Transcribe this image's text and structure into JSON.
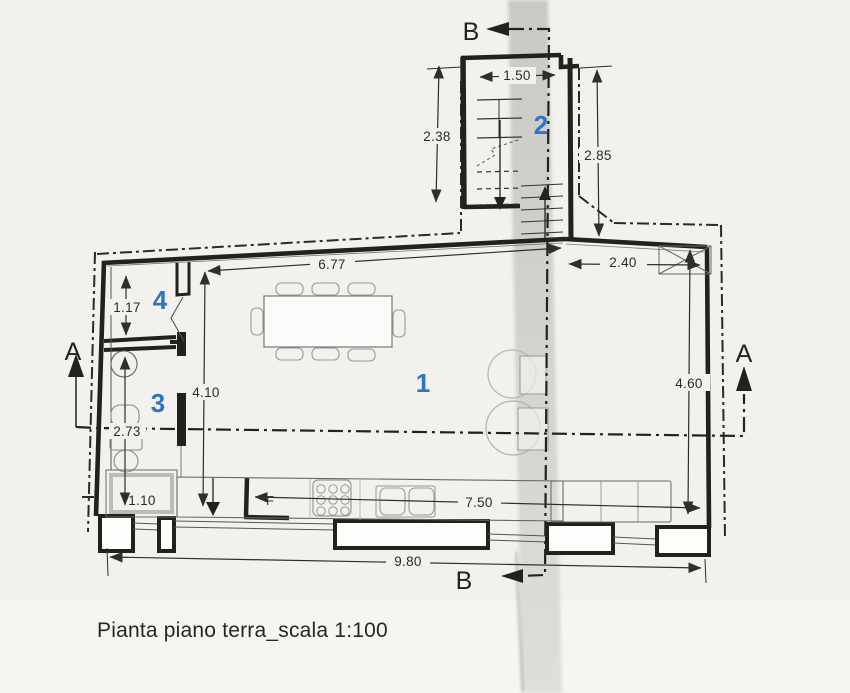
{
  "document": {
    "title": "Pianta piano terra_scala 1:100",
    "type": "scanned architectural floor plan, ground floor, scale 1:100"
  },
  "colors": {
    "paper": "#f2f1ed",
    "ink": "#22221f",
    "room_label_blue": "#2e74c4",
    "scan_band_gray": "#cbccc7"
  },
  "rooms": {
    "living": "1",
    "stairwell": "2",
    "bathroom": "3",
    "vestibule": "4"
  },
  "dimensions": {
    "stair_width": "1.50",
    "stair_left_height": "2.38",
    "stair_right_height": "2.85",
    "living_top_width": "6.77",
    "right_wing_width": "2.40",
    "right_wing_height": "4.60",
    "vestibule_height": "1.17",
    "mid_vertical": "4.10",
    "bath_height": "2.73",
    "tub_width": "1.10",
    "kitchen_run": "7.50",
    "total_width": "9.80"
  },
  "sections": {
    "a": "A",
    "b": "B"
  },
  "labels": {
    "fixture_f": "F"
  }
}
